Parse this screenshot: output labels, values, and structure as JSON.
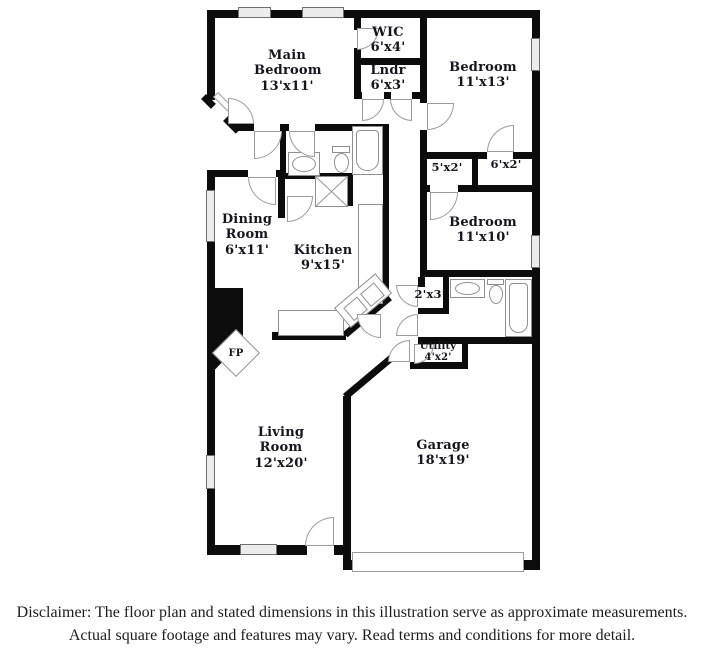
{
  "floorplan": {
    "rooms": {
      "main_bedroom": {
        "name": "Main Bedroom",
        "dims": "13'x11'"
      },
      "wic": {
        "name": "WIC",
        "dims": "6'x4'"
      },
      "laundry": {
        "name": "Lndr",
        "dims": "6'x3'"
      },
      "bedroom_top_right": {
        "name": "Bedroom",
        "dims": "11'x13'"
      },
      "closet_left": {
        "dims": "5'x2'"
      },
      "closet_right": {
        "dims": "6'x2'"
      },
      "bedroom_mid_right": {
        "name": "Bedroom",
        "dims": "11'x10'"
      },
      "dining_room": {
        "name": "Dining Room",
        "dims": "6'x11'"
      },
      "kitchen": {
        "name": "Kitchen",
        "dims": "9'x15'"
      },
      "closet_small": {
        "dims": "2'x3'"
      },
      "utility": {
        "name": "Utility",
        "dims": "4'x2'"
      },
      "fireplace": {
        "name": "FP"
      },
      "living_room": {
        "name": "Living Room",
        "dims": "12'x20'"
      },
      "garage": {
        "name": "Garage",
        "dims": "18'x19'"
      }
    },
    "colors": {
      "wall": "#0c0c0c",
      "fixture_outline": "#8f8f8f",
      "label_text": "#15151d"
    }
  },
  "disclaimer": {
    "line1": "Disclaimer: The floor plan and stated dimensions in this illustration serve as approximate measurements.",
    "line2": "Actual square footage and features may vary. Read terms and conditions for more detail."
  }
}
